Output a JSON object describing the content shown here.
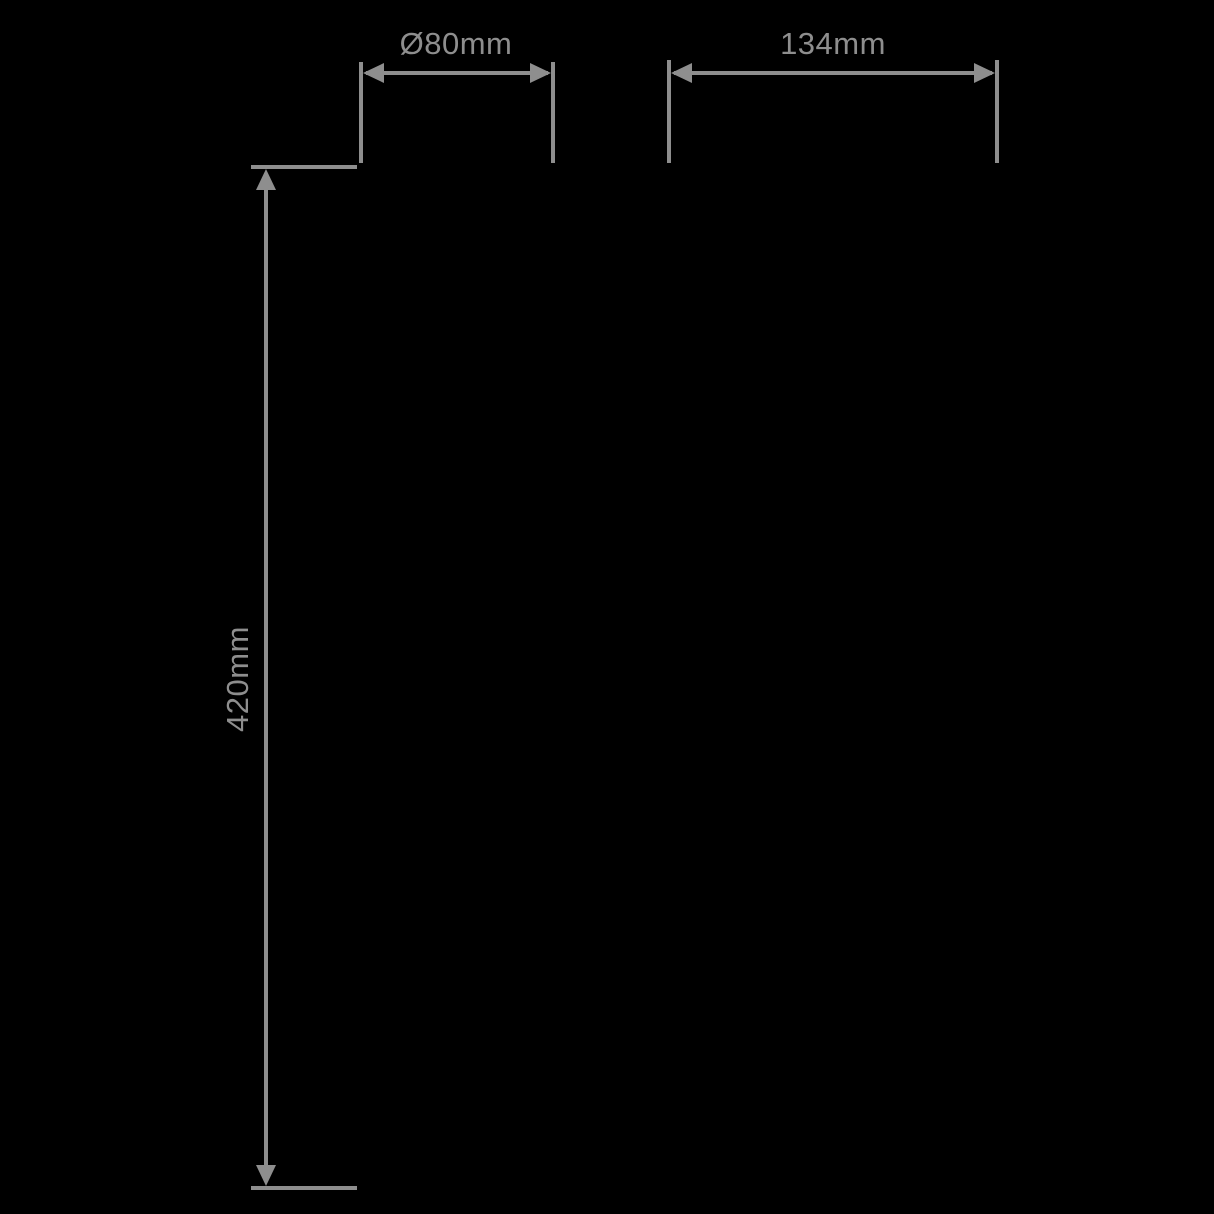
{
  "diagram": {
    "type": "dimension-drawing",
    "background": "#000000",
    "line_color": "#8e8e8e",
    "dimensions": [
      {
        "id": "diameter-top-left",
        "label": "Ø80mm",
        "orientation": "horizontal",
        "value_mm": 80,
        "is_diameter": true
      },
      {
        "id": "width-top-right",
        "label": "134mm",
        "orientation": "horizontal",
        "value_mm": 134,
        "is_diameter": false
      },
      {
        "id": "height-left",
        "label": "420mm",
        "orientation": "vertical",
        "value_mm": 420,
        "is_diameter": false
      }
    ]
  }
}
